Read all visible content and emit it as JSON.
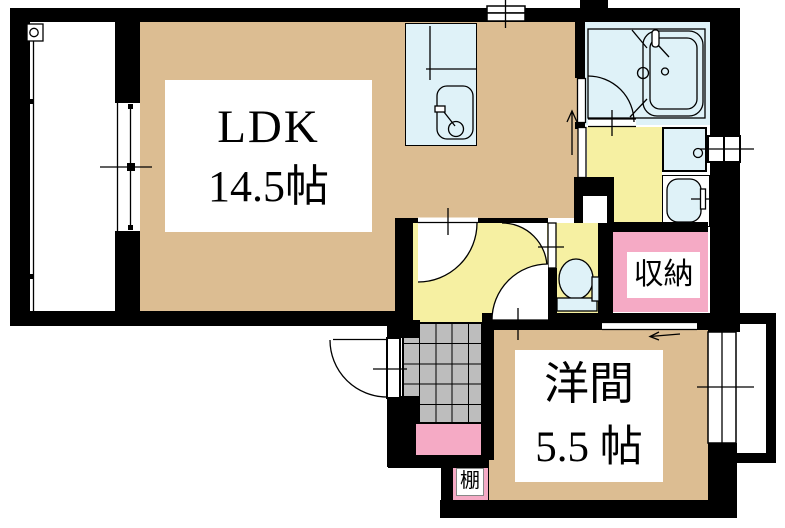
{
  "floorplan": {
    "rooms": {
      "ldk": {
        "label": "LDK",
        "size": "14.5帖"
      },
      "western_room": {
        "label": "洋間",
        "size": "5.5 帖"
      },
      "closet": {
        "label": "収納"
      },
      "shelf": {
        "label": "棚"
      }
    },
    "icons": [
      "kitchen-sink-icon",
      "bathtub-icon",
      "faucet-icon",
      "toilet-icon",
      "washbasin-icon",
      "washing-machine-pan-icon",
      "door-swing-icon",
      "sliding-door-arrow-icon",
      "entry-arrow-icon",
      "window-icon",
      "balcony-drain-icon"
    ],
    "colors": {
      "room_tan": "#DCBD92",
      "wet_yellow": "#F6F0A2",
      "closet_pink": "#F5AAC5",
      "fixture_blue": "#DFF2F8",
      "tile_gray": "#BDBDBD",
      "wall_black": "#000000",
      "bg_white": "#FFFFFF"
    }
  }
}
